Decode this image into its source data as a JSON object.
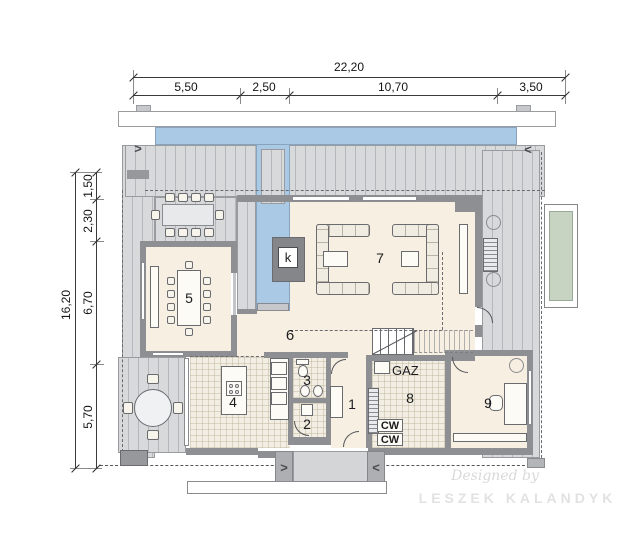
{
  "dimensions": {
    "top": {
      "total": "22,20",
      "segments": [
        {
          "label": "5,50"
        },
        {
          "label": "2,50"
        },
        {
          "label": "10,70"
        },
        {
          "label": "3,50"
        }
      ]
    },
    "left": {
      "total": "16,20",
      "segments": [
        {
          "label": "1,50"
        },
        {
          "label": "2,30"
        },
        {
          "label": "6,70"
        },
        {
          "label": "5,70"
        }
      ]
    }
  },
  "rooms": {
    "entrance_hall": "1",
    "utility_hall": "2",
    "wc": "3",
    "kitchen": "4",
    "dining": "5",
    "open_area": "6",
    "living": "7",
    "technical": "8",
    "office": "9"
  },
  "annotations": {
    "fireplace": "k",
    "gas": "GAZ",
    "hot_water_1": "CW",
    "hot_water_2": "CW"
  },
  "icons": {
    "arrow_right": ">",
    "arrow_left": "<"
  },
  "watermark": {
    "line1": "Designed by",
    "line2": "LESZEK KALANDYK"
  },
  "colors": {
    "water": "#a9c9e5",
    "deck": "#d8d9db",
    "floor": "#f6efe2",
    "wall": "#8e8f93",
    "pool_green": "#c7d4c2"
  }
}
